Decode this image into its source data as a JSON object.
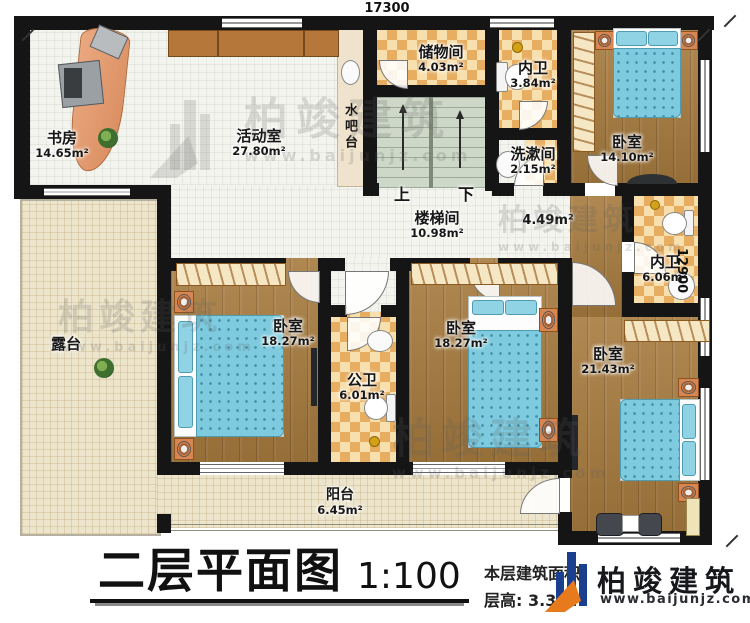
{
  "title_block": {
    "plan_title": "二层平面图",
    "scale": "1:100",
    "area_label": "本层建筑面积:",
    "height_label": "层高:",
    "height_value": "3.3m"
  },
  "dimensions": {
    "top": "17300",
    "right": "12900"
  },
  "brand": {
    "name": "柏竣建筑",
    "website": "www.baijunjz.com"
  },
  "stairs": {
    "up": "上",
    "down": "下"
  },
  "rooms": {
    "study": {
      "name": "书房",
      "area": "14.65m²"
    },
    "activity": {
      "name": "活动室",
      "area": "27.80m²"
    },
    "water_bar": {
      "name": "水吧台"
    },
    "storage": {
      "name": "储物间",
      "area": "4.03m²"
    },
    "bath_n": {
      "name": "内卫",
      "area": "3.84m²"
    },
    "wash": {
      "name": "洗漱间",
      "area": "2.15m²"
    },
    "bedroom_ne": {
      "name": "卧室",
      "area": "14.10m²"
    },
    "stairwell": {
      "name": "楼梯间",
      "area": "10.98m²"
    },
    "hall": {
      "area": "4.49m²"
    },
    "bath_e": {
      "name": "内卫",
      "area": "6.06m²"
    },
    "terrace": {
      "name": "露台"
    },
    "bedroom_w": {
      "name": "卧室",
      "area": "18.27m²"
    },
    "bath_public": {
      "name": "公卫",
      "area": "6.01m²"
    },
    "bedroom_m": {
      "name": "卧室",
      "area": "18.27m²"
    },
    "bedroom_se": {
      "name": "卧室",
      "area": "21.43m²"
    },
    "balcony": {
      "name": "阳台",
      "area": "6.45m²"
    }
  },
  "colors": {
    "wall": "#151515",
    "wood": "#a67a3e",
    "tile": "#e7ae62",
    "bed": "#7ecade",
    "logo_blue": "#1b3f8f",
    "logo_orange": "#e87a1e"
  }
}
